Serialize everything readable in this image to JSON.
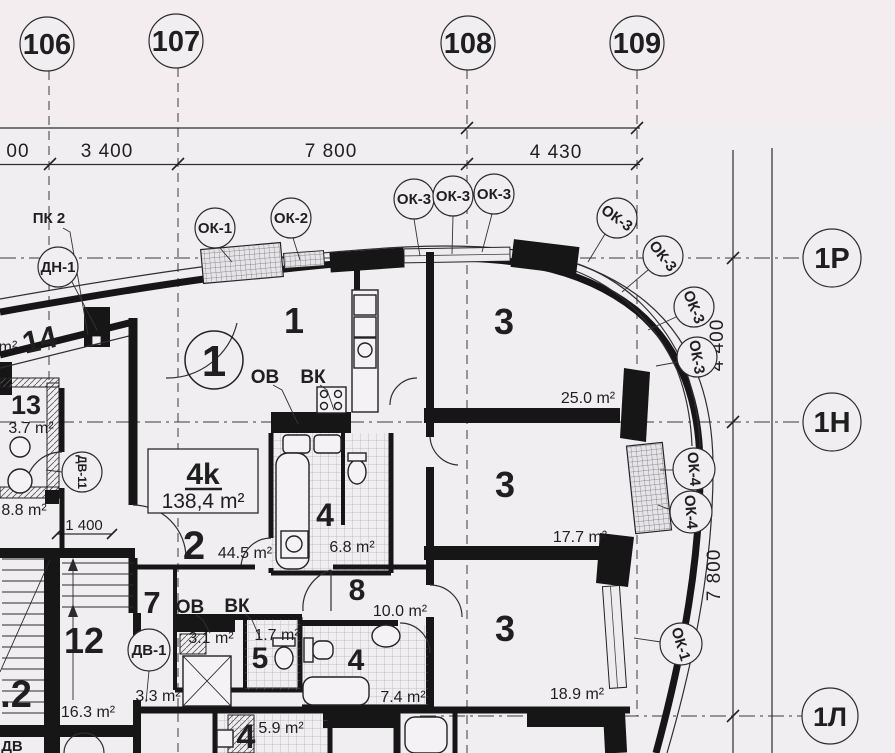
{
  "drawing_type": "architectural floor plan (scanned blueprint)",
  "colors": {
    "paper": "#f1eef1",
    "ink": "#1f1f1f",
    "wall": "#161616"
  },
  "axes": {
    "top": [
      {
        "label": "106"
      },
      {
        "label": "107"
      },
      {
        "label": "108"
      },
      {
        "label": "109"
      }
    ],
    "right": [
      {
        "label": "1Р"
      },
      {
        "label": "1Н"
      },
      {
        "label": "1Л"
      }
    ]
  },
  "dims": {
    "left_cut": "00",
    "a": "3 400",
    "b": "7 800",
    "c": "4 430",
    "right_top": "4 400",
    "right_bottom": "7 800",
    "hall": "1 400"
  },
  "apartment": {
    "type_label": "4k",
    "area_label": "138,4 m²"
  },
  "callouts": {
    "pk2": "ПК 2",
    "dn1": "ДН-1",
    "ok1_top": "ОК-1",
    "ok2": "ОК-2",
    "ok3_1": "ОК-3",
    "ok3_2": "ОК-3",
    "ok3_3": "ОК-3",
    "ok3_4": "ОК-3",
    "ok3_5": "ОК-3",
    "ok3_6": "ОК-3",
    "ok3_7": "ОК-3",
    "ok4_1": "ОК-4",
    "ok4_2": "ОК-4",
    "ok1_right": "ОК-1",
    "dv11": "ДВ-11",
    "dv1": "ДВ-1",
    "dv_cut": "ДВ"
  },
  "rooms": {
    "r14": "14",
    "m2_cut": "m²",
    "r13": "13",
    "r13_area": "3.7 m²",
    "r8_8_area": "8.8 m²",
    "r12": "12",
    "r12_area": "16.3 m²",
    "r2cut": ".2",
    "r7": "7",
    "r7_area": "3.3 m²",
    "r1a": "1",
    "r1b": "1",
    "r2": "2",
    "r2_area": "44.5 m²",
    "r3a": "3",
    "r3a_area": "25.0 m²",
    "r3b": "3",
    "r3b_area": "17.7 m²",
    "r3c": "3",
    "r3c_area": "18.9 m²",
    "r4a": "4",
    "r4a_area": "6.8 m²",
    "r8": "8",
    "r8_area": "10.0 m²",
    "r5": "5",
    "r5_area": "1.7 m²",
    "util_area": "3.1 m²",
    "r4b": "4",
    "r4b_area": "7.4 m²",
    "r4c": "4",
    "r4c_area": "5.9 m²"
  },
  "risers": {
    "ov1": "ОВ",
    "vk1": "ВК",
    "ov2": "ОВ",
    "vk2": "ВК"
  }
}
